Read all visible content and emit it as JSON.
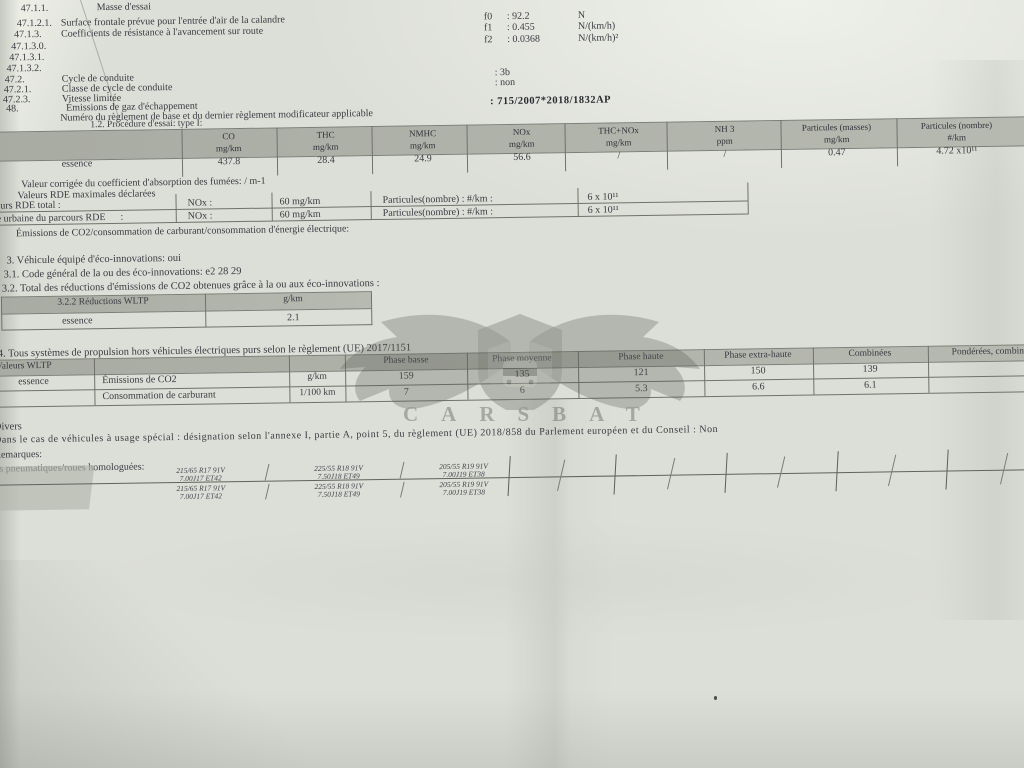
{
  "top_section": {
    "rows": [
      {
        "num": "47.1.1.",
        "label": "Masse d'essai",
        "param": "",
        "value": "",
        "unit": ""
      },
      {
        "num": "47.1.2.1.",
        "label": "Surface frontale prévue pour l'entrée d'air de la calandre",
        "param": "f0",
        "value": ": 92.2",
        "unit": "N"
      },
      {
        "num": "47.1.3.",
        "label": "Coefficients de résistance à l'avancement sur route",
        "param": "f1",
        "value": ": 0.455",
        "unit": "N/(km/h)"
      },
      {
        "num": "47.1.3.0.",
        "label": "",
        "param": "f2",
        "value": ": 0.0368",
        "unit": "N/(km/h)²"
      },
      {
        "num": "47.1.3.1.",
        "label": "",
        "param": "",
        "value": "",
        "unit": ""
      },
      {
        "num": "47.1.3.2.",
        "label": "",
        "param": "",
        "value": "",
        "unit": ""
      },
      {
        "num": "47.2.",
        "label": "Cycle de conduite",
        "param": "",
        "value": ": 3b",
        "unit": ""
      },
      {
        "num": "47.2.1.",
        "label": "Classe de cycle de conduite",
        "param": "",
        "value": ": non",
        "unit": ""
      },
      {
        "num": "47.2.3.",
        "label": "Vitesse limitée",
        "param": "",
        "value": "",
        "unit": ""
      },
      {
        "num": "48.",
        "label": "Émissions de gaz d'échappement",
        "param": "",
        "value": ": 715/2007*2018/1832AP",
        "unit": ""
      },
      {
        "num": "",
        "label": "Numéro du règlement de base et du dernier règlement modificateur applicable",
        "param": "",
        "value": "",
        "unit": ""
      }
    ]
  },
  "type1_table": {
    "caption": "1.2. Procédure d'essai: type I:",
    "fuel_row_label": "essence",
    "columns": [
      {
        "title": "CO",
        "unit": "mg/km",
        "value": "437.8"
      },
      {
        "title": "THC",
        "unit": "mg/km",
        "value": "28.4"
      },
      {
        "title": "NMHC",
        "unit": "mg/km",
        "value": "24.9"
      },
      {
        "title": "NOx",
        "unit": "mg/km",
        "value": "56.6"
      },
      {
        "title": "THC+NOx",
        "unit": "mg/km",
        "value": "/"
      },
      {
        "title": "NH 3",
        "unit": "ppm",
        "value": "/"
      },
      {
        "title": "Particules (masses)",
        "unit": "mg/km",
        "value": "0.47"
      },
      {
        "title": "Particules (nombre)",
        "unit": "#/km",
        "value": "4.72 x10¹¹"
      }
    ]
  },
  "rde": {
    "smoke_line": "Valeur corrigée du coefficient d'absorption des fumées: / m-1",
    "declared_line": "Valeurs RDE maximales déclarées",
    "rows": [
      {
        "label": "Parcours RDE total :",
        "pollutant": "NOx :",
        "limit": "60 mg/km",
        "particles_label": "Particules(nombre) : #/km :",
        "particles_value": "6 x 10¹¹"
      },
      {
        "label": "Partie urbaine du parcours RDE      :",
        "pollutant": "NOx :",
        "limit": "60 mg/km",
        "particles_label": "Particules(nombre) : #/km :",
        "particles_value": "6 x 10¹¹"
      }
    ],
    "co2_line": "Émissions de CO2/consommation de carburant/consommation d'énergie électrique:"
  },
  "eco": {
    "equipped_line": "3. Véhicule équipé d'éco-innovations: oui",
    "code_line": "3.1. Code général de la ou des éco-innovations: e2 28 29",
    "total_line": "3.2. Total des réductions d'émissions de CO2 obtenues grâce à la ou aux éco-innovations :",
    "table": {
      "header_label": "3.2.2 Réductions WLTP",
      "header_unit": "g/km",
      "row_label": "essence",
      "row_value": "2.1"
    }
  },
  "wltp": {
    "intro_line": "4. Tous systèmes de propulsion hors véhicules électriques purs selon le règlement (UE) 2017/1151",
    "corner_label": "Valeurs WLTP",
    "fuel": "essence",
    "phases": [
      "Phase basse",
      "Phase moyenne",
      "Phase haute",
      "Phase extra-haute",
      "Combinées",
      "Pondérées, combinées"
    ],
    "rows": [
      {
        "param": "Émissions de CO2",
        "unit": "g/km",
        "values": [
          "159",
          "135",
          "121",
          "150",
          "139",
          ""
        ]
      },
      {
        "param": "Consommation de carburant",
        "unit": "1/100 km",
        "values": [
          "7",
          "6",
          "5.3",
          "6.6",
          "6.1",
          ""
        ]
      }
    ]
  },
  "divers": {
    "title": "Divers",
    "special_line": "Dans le cas de véhicules à usage spécial : désignation selon l'annexe I, partie A, point 5, du règlement (UE) 2018/858 du Parlement européen et du Conseil : Non",
    "remarks_label": "Remarques:",
    "tyres_label": "Dimensions pneumatiques/roues homologuées:",
    "tyre_rows": [
      {
        "cells": [
          {
            "size": "215/65 R17 91V",
            "rim": "7.00J17 ET42"
          },
          {
            "size": "225/55 R18 91V",
            "rim": "7.50J18 ET49"
          },
          {
            "size": "205/55 R19 91V",
            "rim": "7.00J19 ET38"
          }
        ]
      },
      {
        "cells": [
          {
            "size": "215/65 R17 91V",
            "rim": "7.00J17 ET42"
          },
          {
            "size": "225/55 R18 91V",
            "rim": "7.50J18 ET49"
          },
          {
            "size": "205/55 R19 91V",
            "rim": "7.00J19 ET38"
          }
        ]
      }
    ]
  },
  "watermark": {
    "text": "CARSBAT"
  },
  "colors": {
    "paper": "#dcdfd7",
    "ink": "#3a3a42",
    "table_band": "#b0b3aa",
    "line": "#70736c",
    "watermark": "#5a5e56"
  }
}
